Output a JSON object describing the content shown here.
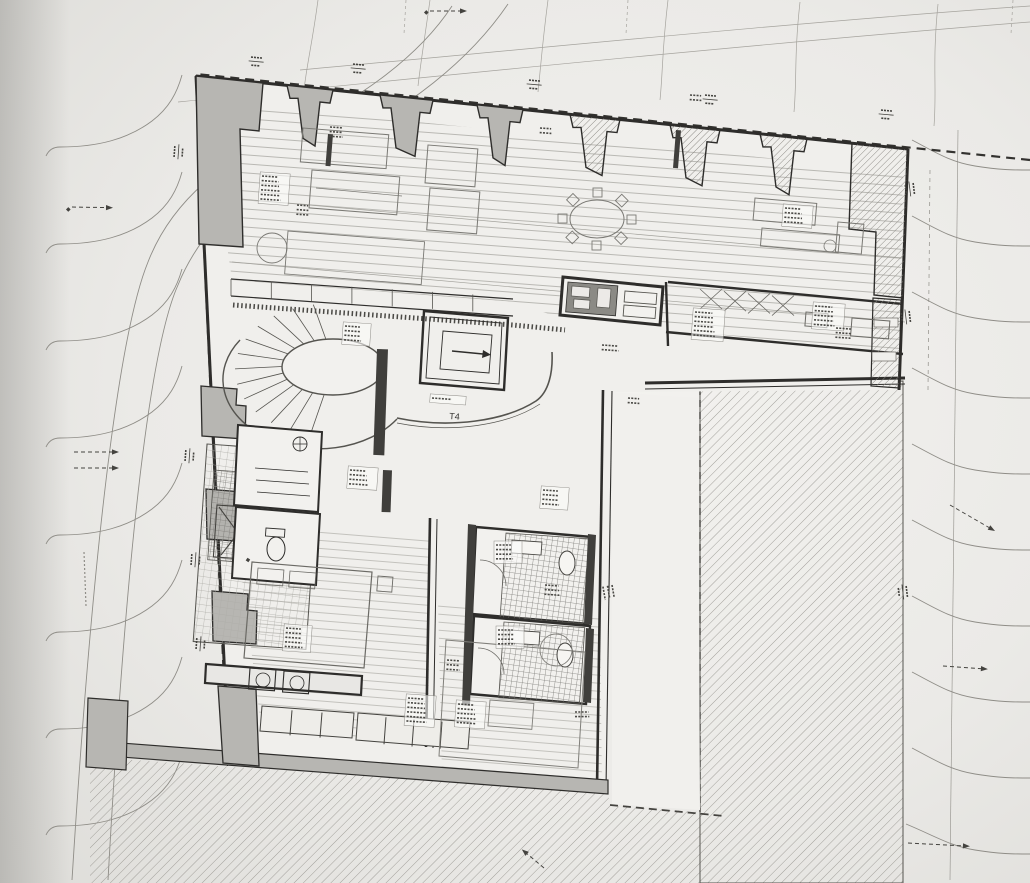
{
  "labels": {
    "unit_type": "T4"
  },
  "icons": {
    "survey_marker": "◆"
  },
  "colors": {
    "paper": "#eae9e6",
    "paper_bright": "#f4f3f0",
    "paper_shadow": "#d8d7d3",
    "ink": "#2e2d2b",
    "ink_medium": "#55544f",
    "ink_light": "#97958e",
    "wall_fill": "#b7b6b2",
    "pier_hatch_bg": "#dddbd6",
    "dark_fixture": "#403f3c",
    "tile_line": "#7d7c78",
    "deck_line": "#b9b8b3"
  }
}
